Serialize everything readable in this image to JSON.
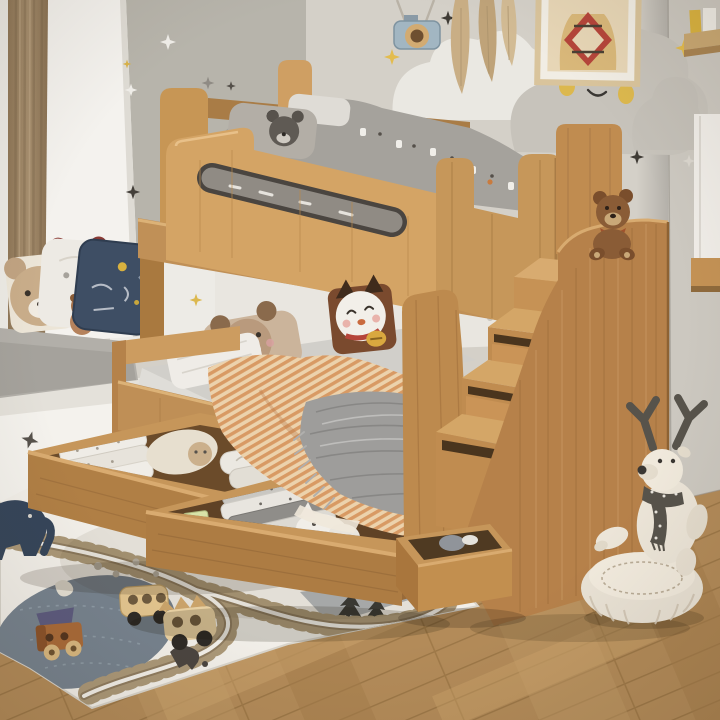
{
  "meta": {
    "title": "Children's bedroom with wooden bunk bed, storage staircase and play rug",
    "alt": "Photo of a kids' room: a beech-wood bunk bed with a guard rail, a lower pull-out bed with striped bedding, two pulled-out storage drawers full of folded blankets and toys, a storage staircase with a teddy bear on top, cloud and star wall decals, a window seat with animal pillows, a cream play rug with a train-track print, wooden toy buses, and a plush reindeer on a knitted pouf."
  },
  "palette": {
    "wood_light": "#d8ab70",
    "wood": "#c6975b",
    "wood_mid": "#b5824a",
    "wood_dark": "#8d6233",
    "wall_left": "#b7b4ab",
    "wall_right": "#d4d0c8",
    "white_trim": "#f4f2ee",
    "cloud_white": "#eae8e2",
    "cloud_gray": "#c7c3bb",
    "accent_yellow": "#e3bc4e",
    "curtain": "#9d8668",
    "floor": "#b28a58",
    "rug": "#f2efe9",
    "pond": "#76828e",
    "bedding_gray": "#a5a29c",
    "duvet_stripe_a": "#d89a64",
    "duvet_stripe_b": "#ecd2ac",
    "blanket_gray": "#9e9d9b",
    "navy": "#3e4e64",
    "plush_brown": "#8a5c36",
    "plush_cream": "#ece5d8",
    "scarf": "#57534b"
  },
  "room": {
    "left_wall": {
      "label": "grey accent wall with star decals"
    },
    "right_wall": {
      "label": "warm grey wall with cloud decals"
    },
    "wainscot": {
      "label": "white cloud-edge wainscot panel"
    },
    "column": {
      "label": "white window alcove column"
    },
    "curtain": {
      "label": "brown curtain"
    },
    "floor": {
      "label": "oak plank floor"
    }
  },
  "decor": {
    "clouds": [
      {
        "label": "white cloud decal"
      },
      {
        "label": "grey smiling cloud decal with yellow cheeks"
      },
      {
        "label": "grey cloud decal at wall corner"
      }
    ],
    "stars": {
      "label": "star decals",
      "count": 12
    },
    "frame": {
      "label": "framed sweater illustration"
    },
    "camera": {
      "label": "hanging toy camera"
    },
    "pampas": {
      "label": "dried pampas leaves"
    },
    "shelf": {
      "label": "wall shelf with books"
    },
    "wardrobe": {
      "label": "white wardrobe edge"
    }
  },
  "furniture": {
    "bunk_bed": {
      "label": "beech bunk bed with guard rail and oval cut-out",
      "back_panel": {
        "label": "white panel with smiling cloud decal and gold star"
      }
    },
    "lower_bed": {
      "label": "lower bed with grey mattress, bear pillow, lucky-cat cushion, striped duvet and knitted throw"
    },
    "drawers": [
      {
        "label": "under-bed drawer with folded white blankets"
      },
      {
        "label": "under-bed drawer with grey blankets, letter blocks and plush toys"
      }
    ],
    "stairs": {
      "label": "storage staircase with drawers",
      "steps": 4,
      "teddy": "brown teddy bear on top step",
      "bottom_drawer": "pulled-out stair drawer"
    },
    "window_seat": {
      "label": "window seat with grey cushion and star cut-out"
    },
    "pouf": {
      "label": "white knitted pouf"
    }
  },
  "textiles": {
    "seat_pillows": [
      "tan bear pillow",
      "white pillow with red ears",
      "navy accent pillow",
      "small brown bear plush"
    ]
  },
  "toys": {
    "block_letter": "A",
    "items": [
      "wooden bus with peg holes",
      "wooden bus with triangle pegs",
      "wooden truck with purple roof",
      "navy elephant ride-on",
      "plush reindeer with polka-dot scarf",
      "green toy",
      "panda plush",
      "white plush"
    ]
  },
  "rug": {
    "label": "cream play rug with train track loop, grey pond, pine trees and animal prints"
  }
}
